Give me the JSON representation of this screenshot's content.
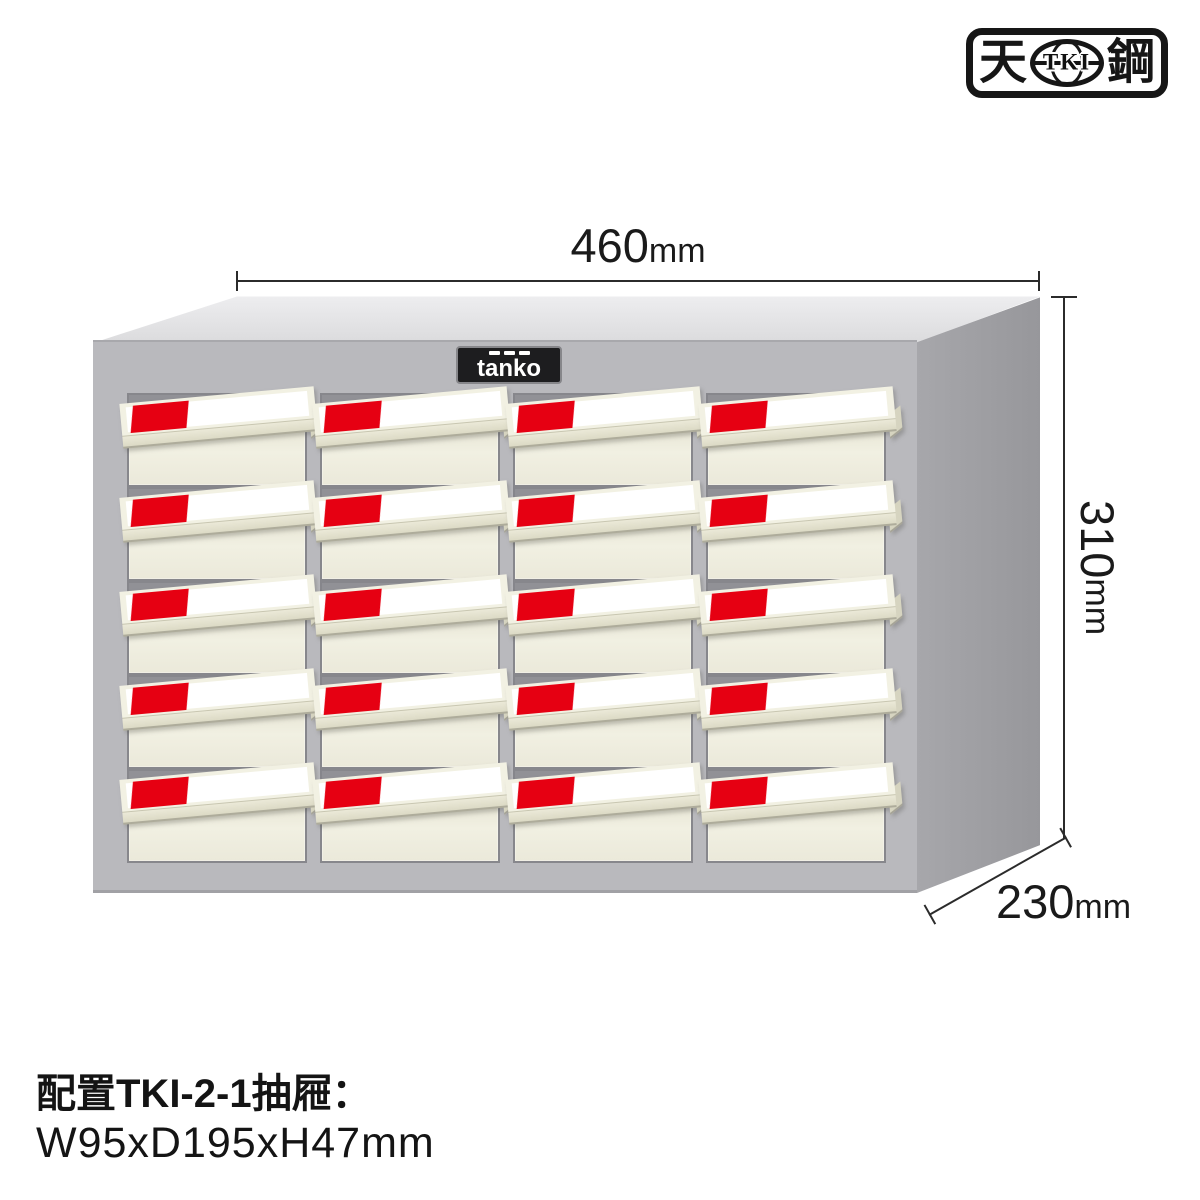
{
  "logo": {
    "left_char": "天",
    "oval_text": "TKI",
    "right_char": "鋼"
  },
  "nameplate": {
    "brand": "tanko"
  },
  "dimensions": {
    "width": {
      "value": "460",
      "unit": "mm"
    },
    "height": {
      "value": "310",
      "unit": "mm"
    },
    "depth": {
      "value": "230",
      "unit": "mm"
    }
  },
  "caption": {
    "line1": "配置TKI-2-1抽屜：",
    "line2": "W95xD195xH47mm"
  },
  "cabinet": {
    "rows": 5,
    "columns": 4,
    "colors": {
      "label_red": "#e60012",
      "drawer_cream": "#eceadb",
      "label_white": "#ffffff",
      "front_face_gray": "#b9b9bd",
      "side_face_gray": "#9b9b9f",
      "top_face_gray": "#dedee0",
      "slot_gray": "#919196",
      "dimension_line": "#2b2b2b"
    }
  }
}
